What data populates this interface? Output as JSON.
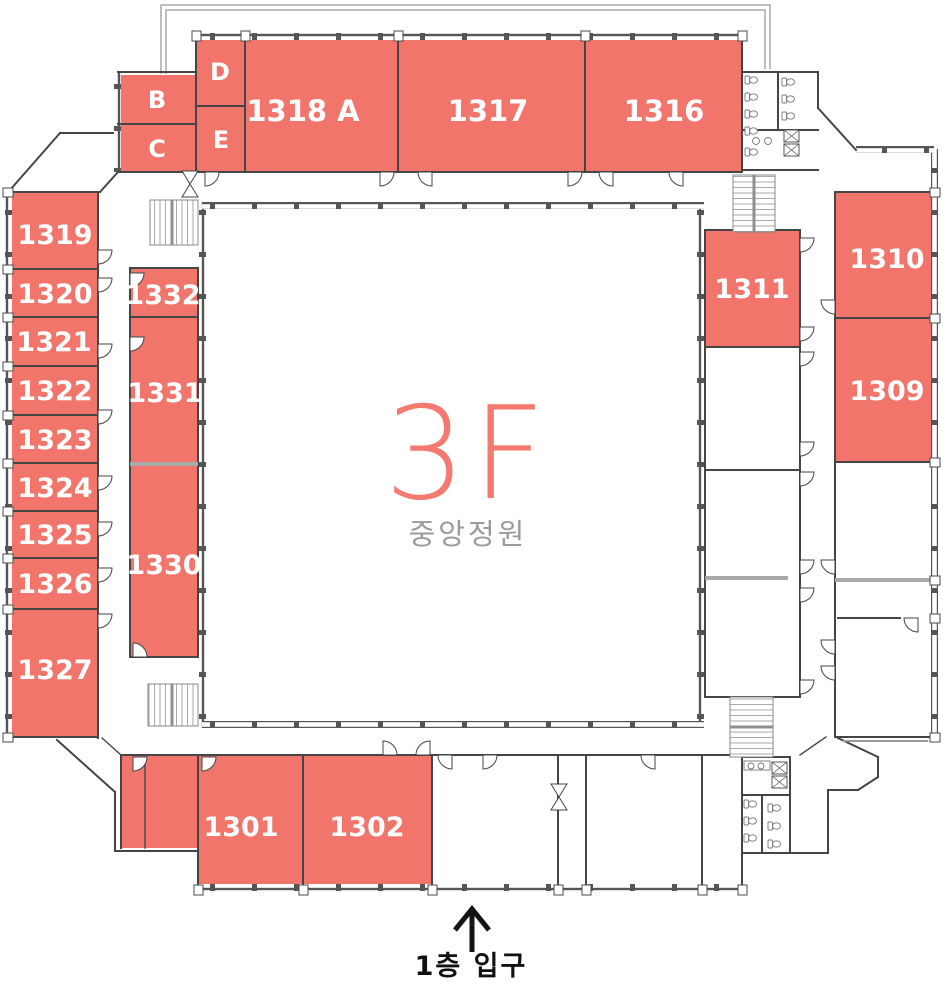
{
  "floor_plan": {
    "floor_label": "3F",
    "courtyard_label": "중앙정원",
    "entrance": {
      "label": "1층 입구",
      "icon": "up-arrow"
    },
    "rooms": [
      {
        "label": "B"
      },
      {
        "label": "C"
      },
      {
        "label": "D"
      },
      {
        "label": "E"
      },
      {
        "label": "1318 A"
      },
      {
        "label": "1317"
      },
      {
        "label": "1316"
      },
      {
        "label": "1319"
      },
      {
        "label": "1320"
      },
      {
        "label": "1321"
      },
      {
        "label": "1322"
      },
      {
        "label": "1323"
      },
      {
        "label": "1324"
      },
      {
        "label": "1325"
      },
      {
        "label": "1326"
      },
      {
        "label": "1327"
      },
      {
        "label": "1332"
      },
      {
        "label": "1331"
      },
      {
        "label": "1330"
      },
      {
        "label": "1311"
      },
      {
        "label": "1310"
      },
      {
        "label": "1309"
      },
      {
        "label": "1301"
      },
      {
        "label": "1302"
      }
    ],
    "colors": {
      "room_fill": "#F1756B",
      "room_label": "#FFFFFF",
      "floor_label": "#F4796F",
      "courtyard_label": "#9B9B9B",
      "walls": "#454545",
      "entrance_text": "#111111"
    }
  }
}
